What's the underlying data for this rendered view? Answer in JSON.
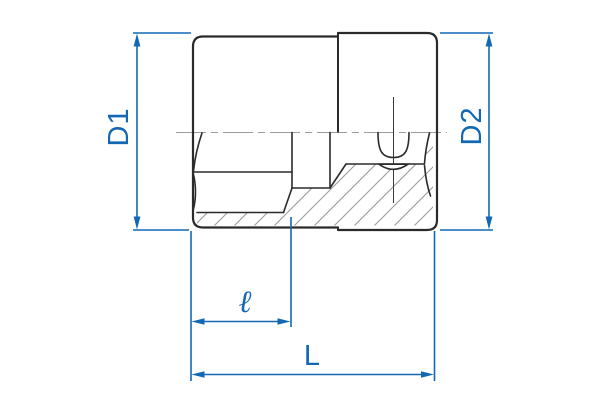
{
  "diagram": {
    "type": "technical-drawing",
    "subject": "socket tool cross-section with dimension lines",
    "labels": {
      "d1": "D1",
      "d2": "D2",
      "length_small": "ℓ",
      "length_total": "L"
    },
    "colors": {
      "dimension_blue": "#1368b4",
      "outline_black": "#2b2b2b",
      "hatch_gray": "#9c9c9c",
      "background": "#ffffff"
    }
  }
}
